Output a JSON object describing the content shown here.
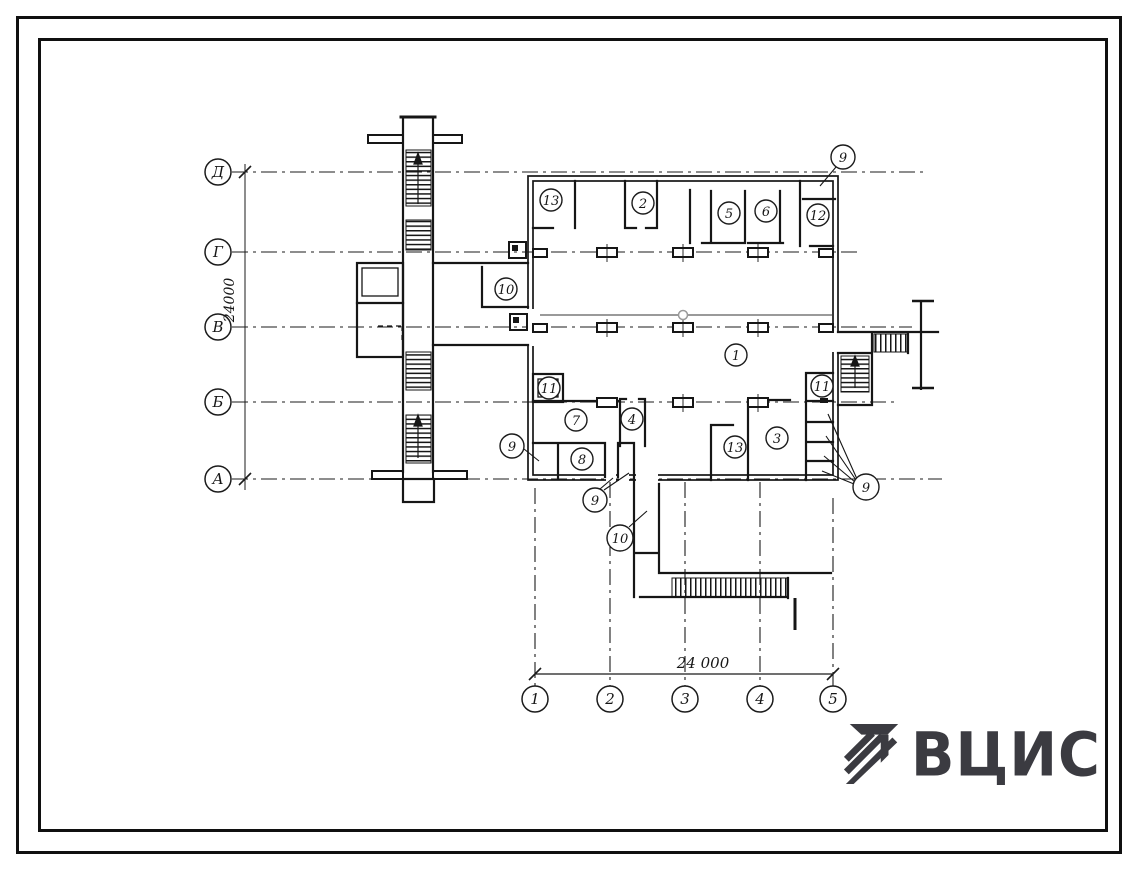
{
  "axes": {
    "rows": [
      {
        "label": "Д"
      },
      {
        "label": "Г"
      },
      {
        "label": "В"
      },
      {
        "label": "Б"
      },
      {
        "label": "А"
      }
    ],
    "columns": [
      {
        "label": "1"
      },
      {
        "label": "2"
      },
      {
        "label": "3"
      },
      {
        "label": "4"
      },
      {
        "label": "5"
      }
    ]
  },
  "dimensions": {
    "vertical": "24000",
    "horizontal": "24 000"
  },
  "rooms": [
    {
      "label": "13"
    },
    {
      "label": "2"
    },
    {
      "label": "5"
    },
    {
      "label": "6"
    },
    {
      "label": "12"
    },
    {
      "label": "10"
    },
    {
      "label": "1"
    },
    {
      "label": "11"
    },
    {
      "label": "7"
    },
    {
      "label": "4"
    },
    {
      "label": "8"
    },
    {
      "label": "13"
    },
    {
      "label": "3"
    },
    {
      "label": "11"
    }
  ],
  "callouts": [
    {
      "label": "9"
    },
    {
      "label": "9"
    },
    {
      "label": "9"
    },
    {
      "label": "9"
    },
    {
      "label": "10"
    }
  ],
  "logo": {
    "text": "ВЦИС",
    "color": "#3b3b41"
  }
}
